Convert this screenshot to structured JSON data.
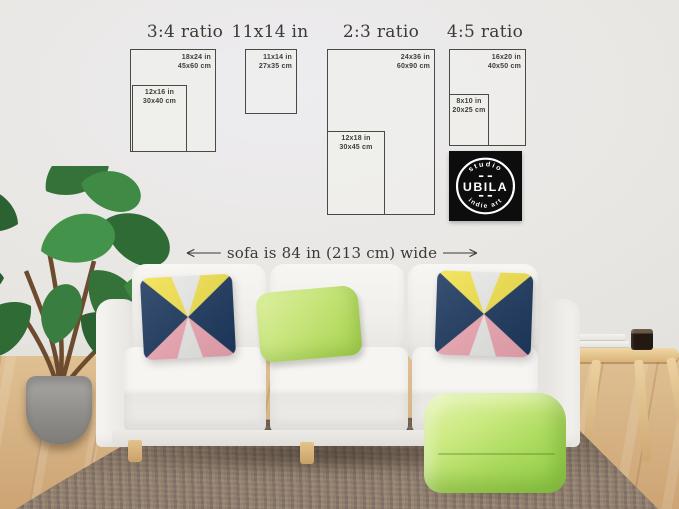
{
  "size_guide": {
    "sections": [
      {
        "title": "3:4 ratio",
        "outer_label": [
          "18x24 in",
          "45x60 cm"
        ],
        "inner_label": [
          "12x16 in",
          "30x40 cm"
        ]
      },
      {
        "title": "11x14 in",
        "outer_label": [
          "11x14 in",
          "27x35 cm"
        ]
      },
      {
        "title": "2:3 ratio",
        "outer_label": [
          "24x36 in",
          "60x90 cm"
        ],
        "inner_label": [
          "12x18 in",
          "30x45 cm"
        ]
      },
      {
        "title": "4:5 ratio",
        "outer_label": [
          "16x20 in",
          "40x50 cm"
        ],
        "inner_label": [
          "8x10 in",
          "20x25 cm"
        ]
      }
    ]
  },
  "logo": {
    "top": "studio",
    "name": "UBILA",
    "bottom": "indie art"
  },
  "annotation": {
    "text": "sofa is 84 in (213 cm) wide"
  },
  "colors": {
    "wall": "#e9e7e3",
    "frame_border": "#4a4944",
    "pillow_navy": "#1e3a60",
    "pillow_yellow": "#f2e14d",
    "pillow_pink": "#f0a9b5",
    "pillow_white": "#ebebe9",
    "green_pillow": "#c9e57e",
    "pouf_green": "#abda5e",
    "rug": "#8d7b6c",
    "floor_wood": "#d9b98c",
    "sofa": "#f3f2ef",
    "logo_bg": "#0d0d0d",
    "logo_text": "#ffffff"
  }
}
